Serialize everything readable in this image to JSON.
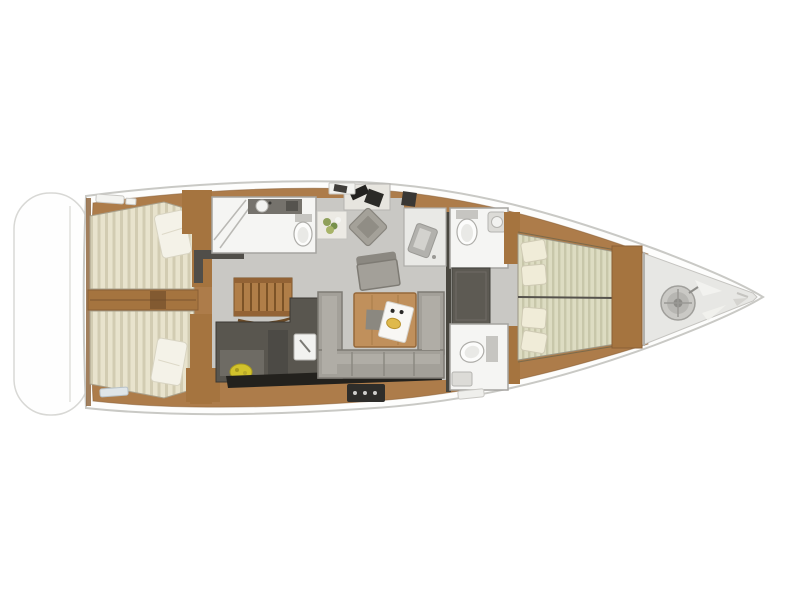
{
  "canvas": {
    "background": "#ffffff"
  },
  "diagram": {
    "kind": "yacht-interior-floor-plan",
    "orientation": "bow-right-stern-left"
  },
  "colors": {
    "hull_white": "#fdfdfc",
    "hull_outline": "#c9c9c5",
    "teak_wood": "#ad7c4a",
    "wood_dark": "#8a5f35",
    "cabin_sole_gray": "#c9c8c4",
    "bow_locker_gray": "#e7e7e4",
    "mattress_cream": "#e8e3cd",
    "mattress_stripe": "#d2ccb2",
    "fwd_mattress_cream": "#dddcc2",
    "fwd_mattress_stripe": "#c8c7aa",
    "pillow_white": "#f4f2e8",
    "sofa_gray": "#a3a099",
    "galley_counter_dark": "#59564f",
    "galley_black": "#23211d",
    "saloon_table_wood": "#c0905c",
    "bathroom_white": "#f5f5f3",
    "bulkhead_dark": "#48463f",
    "fruitbowl_yellow": "#d2c22c",
    "tray_food_yellow": "#dfb94b",
    "windlass_metal": "#cac9c5",
    "plant_green": "#8fa05a"
  }
}
